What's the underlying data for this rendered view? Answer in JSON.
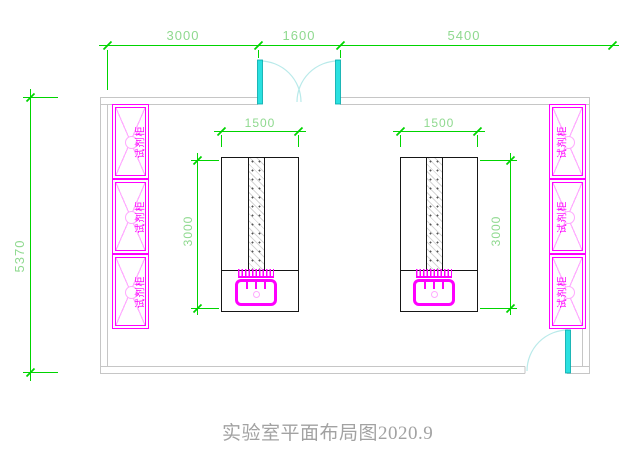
{
  "title": "实验室平面布局图2020.9",
  "dimensions": {
    "top_left": "3000",
    "top_middle": "1600",
    "top_right": "5400",
    "room_height": "5370",
    "hood_left_width": "1500",
    "hood_left_depth": "3000",
    "hood_right_width": "1500",
    "hood_right_depth": "3000"
  },
  "cabinets": {
    "left_labels": [
      "试剂柜",
      "试剂柜",
      "试剂柜"
    ],
    "right_labels": [
      "试剂柜",
      "试剂柜",
      "试剂柜"
    ]
  },
  "colors": {
    "dimension_line": "#00d400",
    "dimension_text": "#8fd98f",
    "wall_line": "#c6c6c6",
    "cabinet_magenta": "#ff00ff",
    "cabinet_pink": "#ffaaff",
    "door_leaf_cyan": "#2ae0e0",
    "door_arc_cyan": "#b9eaea",
    "hood_line": "#161616",
    "title_gray": "#a2a2a2"
  }
}
